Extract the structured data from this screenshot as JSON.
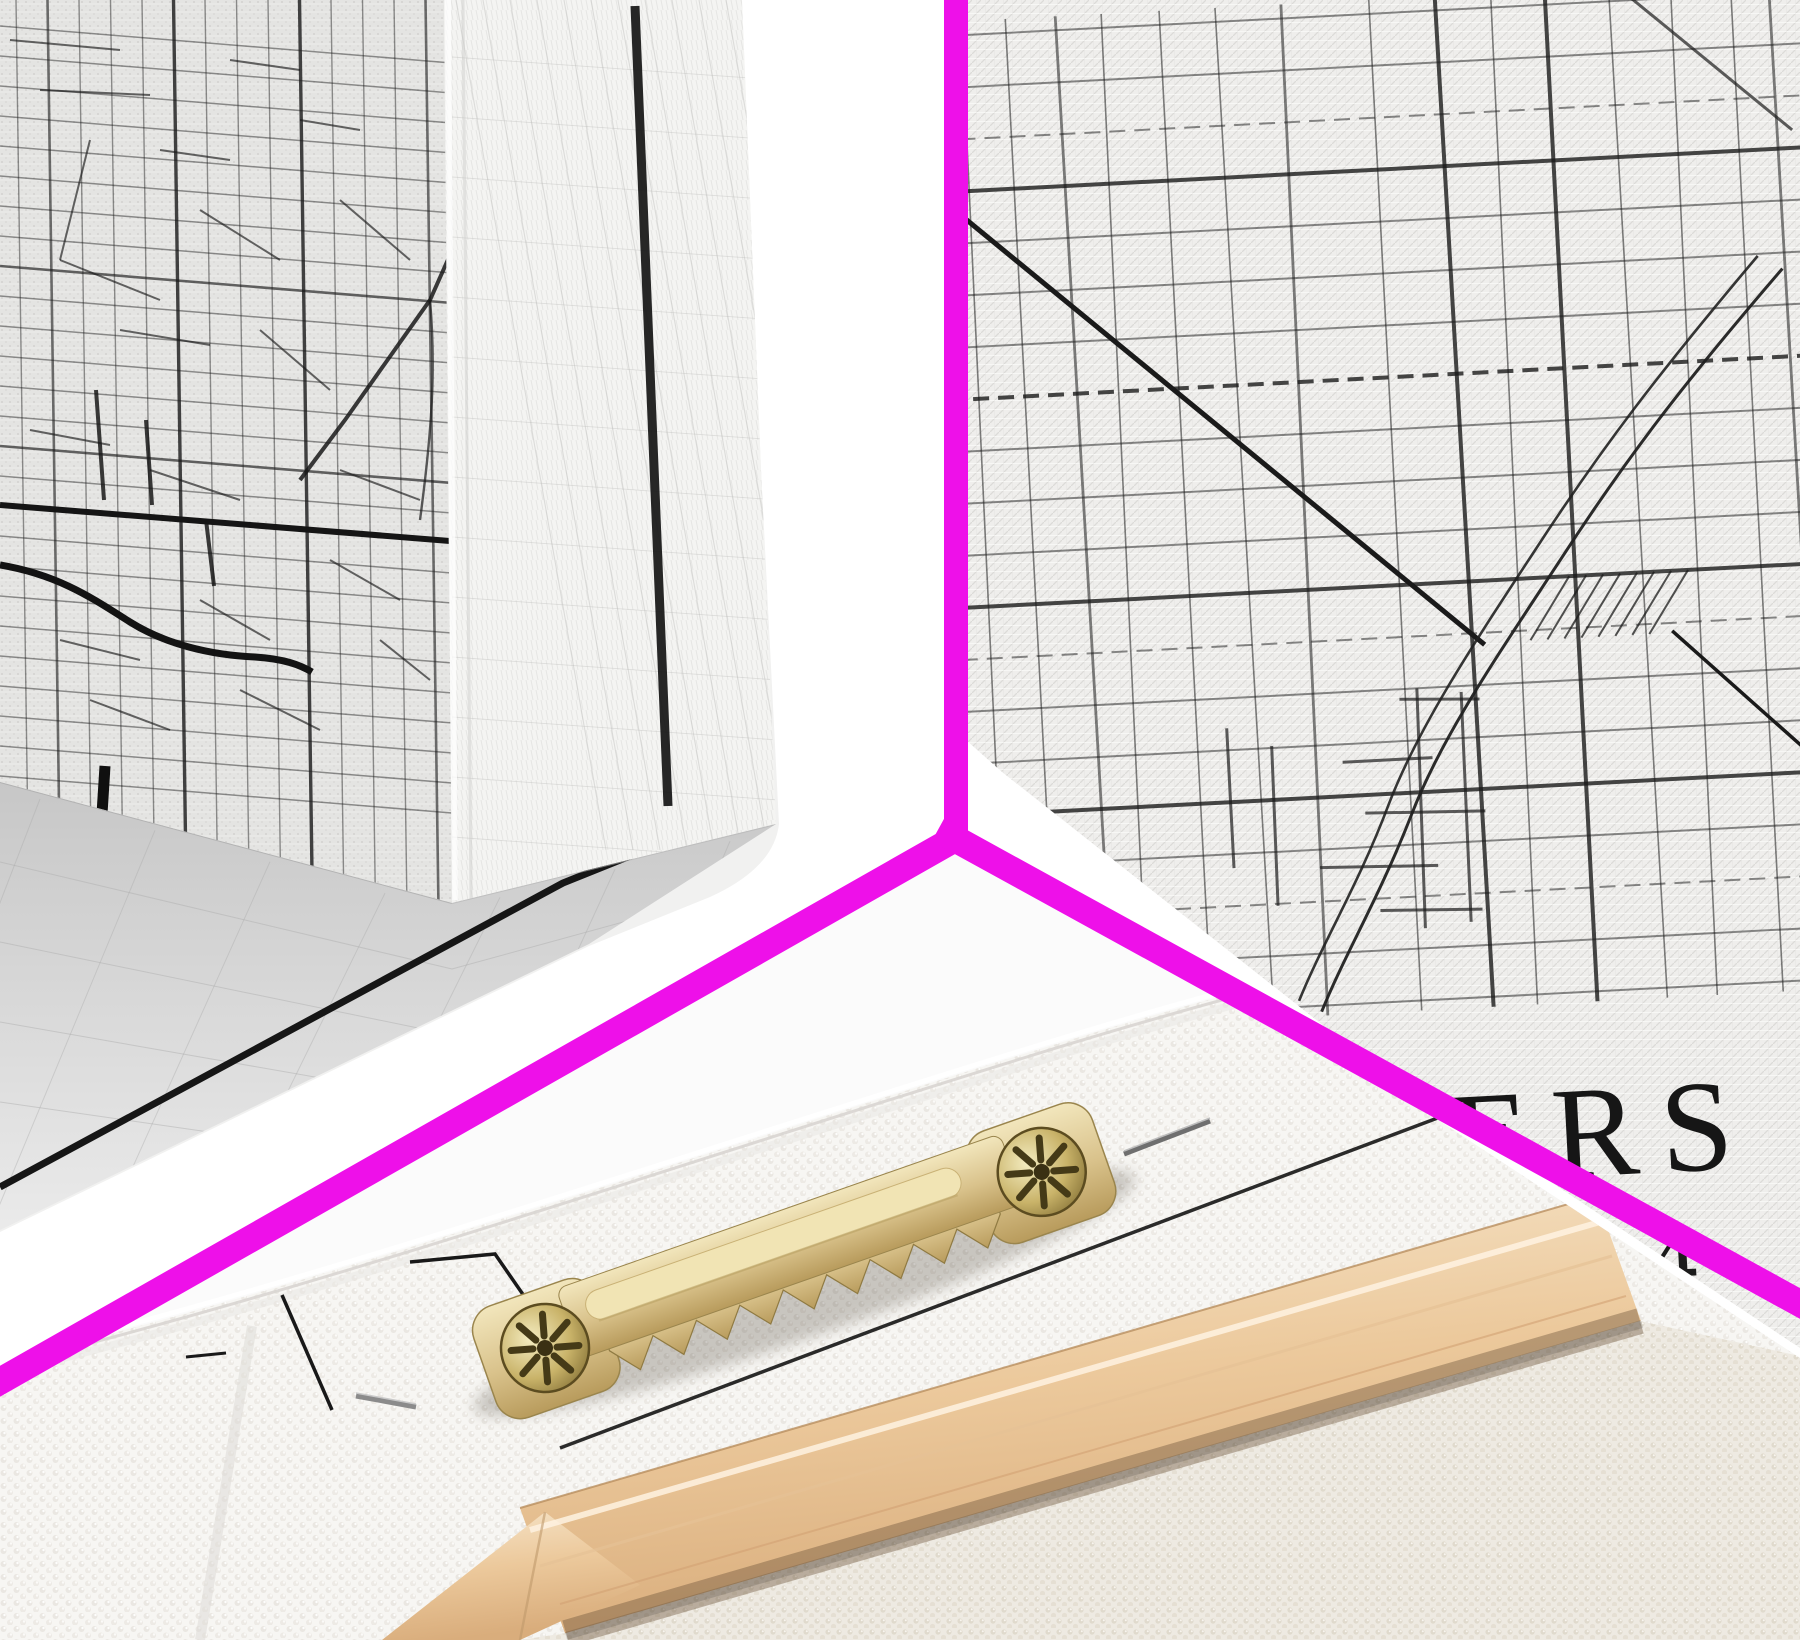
{
  "divider": {
    "color": "#ee10e9"
  },
  "palette": {
    "map_ink": "#1a1a1a",
    "canvas_weave": "#efeeec",
    "pebble_canvas": "#f7f6f3",
    "floor_gray": "#c9c9c9",
    "wood_light": "#f7e7cd",
    "wood_dark": "#d9ad7c",
    "brass_light": "#f2e6bc",
    "brass_dark": "#b89b5c",
    "screw_dark": "#5c4c20"
  },
  "map_print": {
    "title_fragment": "ERS",
    "coordinate_fragment": "04"
  }
}
